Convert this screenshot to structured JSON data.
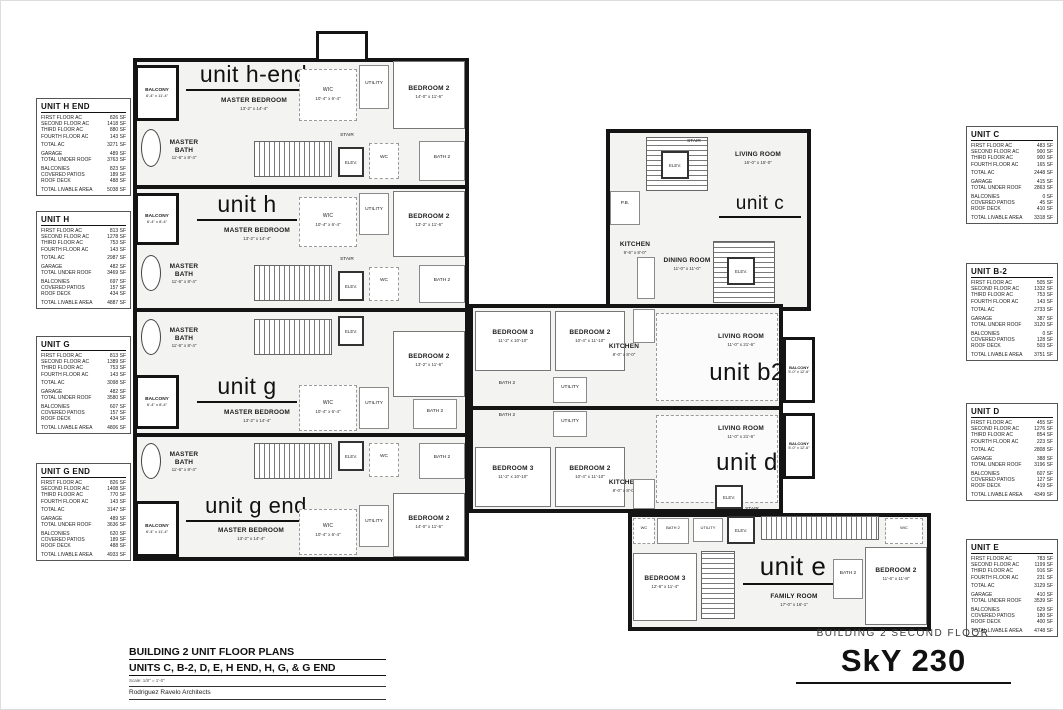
{
  "sheet": {
    "title_block": {
      "line1": "BUILDING 2 UNIT FLOOR PLANS",
      "line2": "UNITS C, B-2, D, E, H END, H, G, & G END",
      "scale": "Scale: 1/8\" = 1'-0\"",
      "architect": "Rodriguez Ravelo Architects"
    },
    "floor_label": "BUILDING 2 SECOND FLOOR",
    "project_name": "SkY 230"
  },
  "row_labels": [
    "FIRST FLOOR AC",
    "SECOND FLOOR AC",
    "THIRD FLOOR AC",
    "FOURTH FLOOR AC",
    "TOTAL AC",
    "GARAGE",
    "TOTAL UNDER ROOF",
    "BALCONIES",
    "COVERED PATIOS",
    "ROOF DECK",
    "TOTAL LIVABLE AREA"
  ],
  "tables": [
    {
      "title": "UNIT H END",
      "values": [
        "826 SF",
        "1418 SF",
        "880 SF",
        "143 SF",
        "3271 SF",
        "489 SF",
        "3763 SF",
        "823 SF",
        "189 SF",
        "488 SF",
        "5038 SF"
      ]
    },
    {
      "title": "UNIT H",
      "values": [
        "813 SF",
        "1278 SF",
        "753 SF",
        "143 SF",
        "2987 SF",
        "482 SF",
        "3469 SF",
        "697 SF",
        "157 SF",
        "434 SF",
        "4887 SF"
      ]
    },
    {
      "title": "UNIT G",
      "values": [
        "813 SF",
        "1389 SF",
        "753 SF",
        "143 SF",
        "3098 SF",
        "482 SF",
        "3580 SF",
        "607 SF",
        "157 SF",
        "434 SF",
        "4806 SF"
      ]
    },
    {
      "title": "UNIT G END",
      "values": [
        "826 SF",
        "1408 SF",
        "770 SF",
        "143 SF",
        "3147 SF",
        "489 SF",
        "3636 SF",
        "620 SF",
        "189 SF",
        "488 SF",
        "4933 SF"
      ]
    },
    {
      "title": "UNIT C",
      "values": [
        "483 SF",
        "900 SF",
        "900 SF",
        "165 SF",
        "2448 SF",
        "415 SF",
        "2863 SF",
        "0 SF",
        "45 SF",
        "410 SF",
        "3318 SF"
      ]
    },
    {
      "title": "UNIT B-2",
      "values": [
        "505 SF",
        "1332 SF",
        "753 SF",
        "143 SF",
        "2733 SF",
        "387 SF",
        "3120 SF",
        "0 SF",
        "128 SF",
        "503 SF",
        "3751 SF"
      ]
    },
    {
      "title": "UNIT D",
      "values": [
        "455 SF",
        "1276 SF",
        "854 SF",
        "223 SF",
        "2808 SF",
        "388 SF",
        "3196 SF",
        "607 SF",
        "127 SF",
        "419 SF",
        "4349 SF"
      ]
    },
    {
      "title": "UNIT E",
      "values": [
        "783 SF",
        "1199 SF",
        "916 SF",
        "231 SF",
        "3129 SF",
        "410 SF",
        "3539 SF",
        "629 SF",
        "180 SF",
        "400 SF",
        "4748 SF"
      ]
    }
  ],
  "units": {
    "h_end": {
      "name": "unit h-end",
      "rooms": {
        "balcony": {
          "label": "BALCONY",
          "dims": "6'-4\" x 11'-4\""
        },
        "master_bedroom": {
          "label": "MASTER BEDROOM",
          "dims": "13'-2\" x 14'-4\""
        },
        "master_bath": {
          "label": "MASTER BATH",
          "dims": "11'-6\" x 8'-4\""
        },
        "wic": {
          "label": "WIC",
          "dims": "10'-4\" x 6'-4\""
        },
        "utility": {
          "label": "UTILITY"
        },
        "bedroom2": {
          "label": "BEDROOM 2",
          "dims": "14'-0\" x 11'-6\""
        },
        "stair": {
          "label": "STAIR"
        },
        "elev": {
          "label": "ELEV."
        },
        "wc": {
          "label": "WC"
        },
        "bath2": {
          "label": "BATH 2"
        }
      }
    },
    "h": {
      "name": "unit h",
      "rooms": {
        "balcony": {
          "label": "BALCONY",
          "dims": "6'-4\" x 8'-4\""
        },
        "master_bedroom": {
          "label": "MASTER BEDROOM",
          "dims": "13'-2\" x 14'-4\""
        },
        "master_bath": {
          "label": "MASTER BATH",
          "dims": "11'-6\" x 8'-4\""
        },
        "wic": {
          "label": "WIC",
          "dims": "10'-4\" x 6'-4\""
        },
        "utility": {
          "label": "UTILITY"
        },
        "bedroom2": {
          "label": "BEDROOM 2",
          "dims": "13'-2\" x 11'-6\""
        },
        "stair": {
          "label": "STAIR"
        },
        "elev": {
          "label": "ELEV."
        },
        "wc": {
          "label": "WC"
        },
        "bath2": {
          "label": "BATH 2"
        }
      }
    },
    "g": {
      "name": "unit g",
      "rooms": {
        "balcony": {
          "label": "BALCONY",
          "dims": "6'-4\" x 8'-4\""
        },
        "master_bedroom": {
          "label": "MASTER BEDROOM",
          "dims": "13'-2\" x 14'-4\""
        },
        "master_bath": {
          "label": "MASTER BATH",
          "dims": "11'-6\" x 8'-4\""
        },
        "wic": {
          "label": "WIC",
          "dims": "10'-4\" x 6'-4\""
        },
        "utility": {
          "label": "UTILITY"
        },
        "bedroom2": {
          "label": "BEDROOM 2",
          "dims": "13'-2\" x 11'-6\""
        },
        "stair": {
          "label": "STAIR"
        },
        "elev": {
          "label": "ELEV."
        },
        "wc": {
          "label": "WC"
        },
        "bath2": {
          "label": "BATH 2"
        }
      }
    },
    "g_end": {
      "name": "unit g end",
      "rooms": {
        "balcony": {
          "label": "BALCONY",
          "dims": "6'-4\" x 11'-4\""
        },
        "master_bedroom": {
          "label": "MASTER BEDROOM",
          "dims": "13'-2\" x 14'-4\""
        },
        "master_bath": {
          "label": "MASTER BATH",
          "dims": "11'-6\" x 8'-4\""
        },
        "wic": {
          "label": "WIC",
          "dims": "10'-4\" x 6'-4\""
        },
        "utility": {
          "label": "UTILITY"
        },
        "bedroom2": {
          "label": "BEDROOM 2",
          "dims": "14'-0\" x 11'-6\""
        },
        "stair": {
          "label": "STAIR"
        },
        "elev": {
          "label": "ELEV."
        },
        "wc": {
          "label": "WC"
        },
        "bath2": {
          "label": "BATH 2"
        }
      }
    },
    "c": {
      "name": "unit c",
      "rooms": {
        "stair": {
          "label": "STAIR"
        },
        "elev": {
          "label": "ELEV."
        },
        "pb": {
          "label": "P.B."
        },
        "kitchen": {
          "label": "KITCHEN",
          "dims": "9'-6\" x 8'-0\""
        },
        "dining": {
          "label": "DINING ROOM",
          "dims": "11'-0\" x 11'-0\""
        },
        "living": {
          "label": "LIVING ROOM",
          "dims": "16'-0\" x 15'-0\""
        }
      }
    },
    "b2": {
      "name": "unit b2",
      "rooms": {
        "bedroom3": {
          "label": "BEDROOM 3",
          "dims": "11'-2\" x 10'-10\""
        },
        "bedroom2": {
          "label": "BEDROOM 2",
          "dims": "10'-4\" x 11'-10\""
        },
        "bath2": {
          "label": "BATH 2"
        },
        "utility": {
          "label": "UTILITY"
        },
        "kitchen": {
          "label": "KITCHEN",
          "dims": "8'-0\" x 8'-0\""
        },
        "living": {
          "label": "LIVING ROOM",
          "dims": "11'-0\" x 21'-6\""
        },
        "balcony": {
          "label": "BALCONY",
          "dims": "5'-0\" x 12'-6\""
        }
      }
    },
    "d": {
      "name": "unit d",
      "rooms": {
        "bedroom3": {
          "label": "BEDROOM 3",
          "dims": "11'-2\" x 10'-10\""
        },
        "bedroom2": {
          "label": "BEDROOM 2",
          "dims": "10'-4\" x 11'-10\""
        },
        "bath2": {
          "label": "BATH 2"
        },
        "utility": {
          "label": "UTILITY"
        },
        "kitchen": {
          "label": "KITCHEN",
          "dims": "8'-0\" x 8'-0\""
        },
        "living": {
          "label": "LIVING ROOM",
          "dims": "11'-0\" x 21'-6\""
        },
        "balcony": {
          "label": "BALCONY",
          "dims": "5'-0\" x 12'-6\""
        },
        "elev": {
          "label": "ELEV."
        }
      }
    },
    "e": {
      "name": "unit e",
      "rooms": {
        "wc": {
          "label": "WC"
        },
        "bath2": {
          "label": "BATH 2"
        },
        "utility": {
          "label": "UTILITY"
        },
        "elev": {
          "label": "ELEV."
        },
        "stair": {
          "label": "STAIR"
        },
        "wic": {
          "label": "WIC"
        },
        "bedroom3": {
          "label": "BEDROOM 3",
          "dims": "12'-6\" x 11'-4\""
        },
        "family": {
          "label": "FAMILY ROOM",
          "dims": "17'-0\" x 16'-1\""
        },
        "bath2b": {
          "label": "BATH 2"
        },
        "bedroom2": {
          "label": "BEDROOM 2",
          "dims": "11'-6\" x 11'-8\""
        }
      }
    }
  }
}
